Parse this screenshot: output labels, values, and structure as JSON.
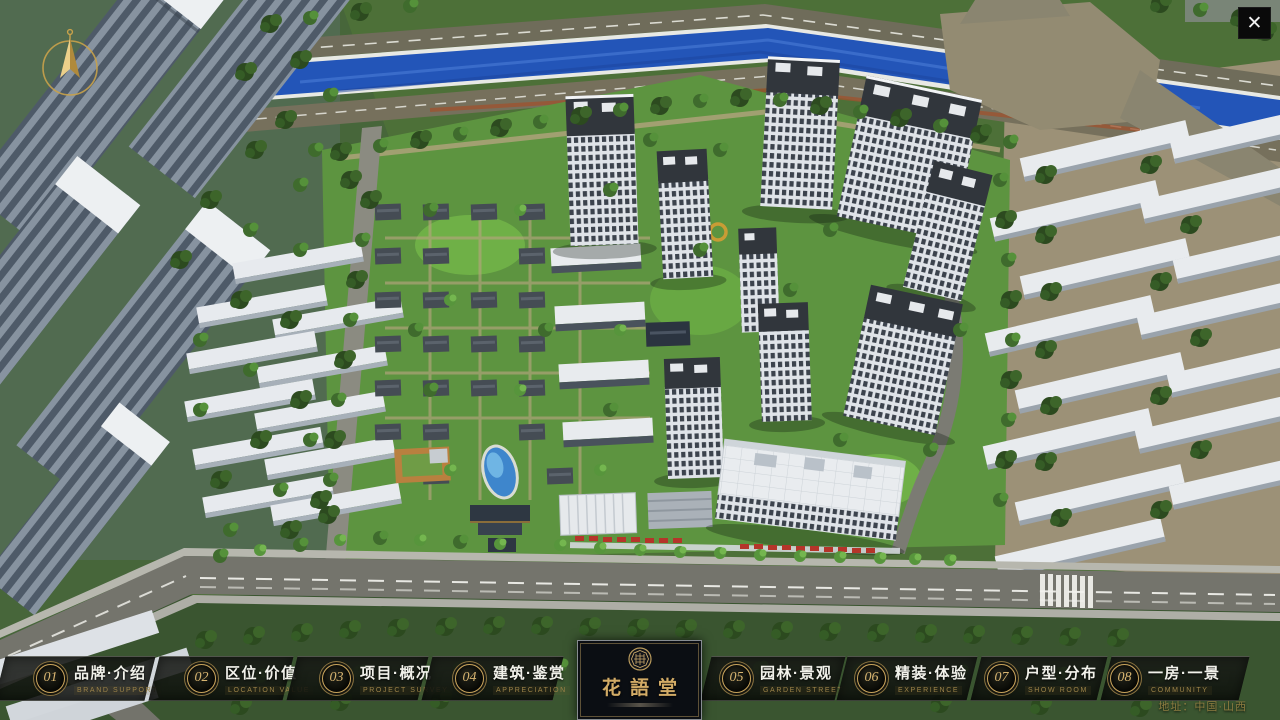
{
  "meta": {
    "screen_title": "花語堂 楼盘展示主菜单"
  },
  "palette": {
    "accent_gold": "#c9a45c",
    "badge_number_gold": "#d8b571",
    "panel_dark": "rgba(12,14,11,0.82)",
    "label_zh_light": "#f1f1ea",
    "label_en_gold": "#9c8349",
    "address_gold": "#8e7d41",
    "river_blue": "#2355b8",
    "site_green": "#5d9440"
  },
  "icons": {
    "close": "✕",
    "compass": "north-arrow",
    "seal": "brand-seal"
  },
  "logo": {
    "title": "花語堂"
  },
  "menu": {
    "items": [
      {
        "num": "01",
        "zh": "品牌·介绍",
        "en": "BRAND SUPPORT"
      },
      {
        "num": "02",
        "zh": "区位·价值",
        "en": "LOCATION VALUE"
      },
      {
        "num": "03",
        "zh": "项目·概况",
        "en": "PROJECT SURVEY"
      },
      {
        "num": "04",
        "zh": "建筑·鉴赏",
        "en": "APPRECIATION"
      },
      {
        "num": "05",
        "zh": "园林·景观",
        "en": "GARDEN STREET"
      },
      {
        "num": "06",
        "zh": "精装·体验",
        "en": "EXPERIENCE"
      },
      {
        "num": "07",
        "zh": "户型·分布",
        "en": "SHOW ROOM"
      },
      {
        "num": "08",
        "zh": "一房·一景",
        "en": "COMMUNITY"
      }
    ]
  },
  "footer": {
    "address": "地址：中国·山西"
  }
}
